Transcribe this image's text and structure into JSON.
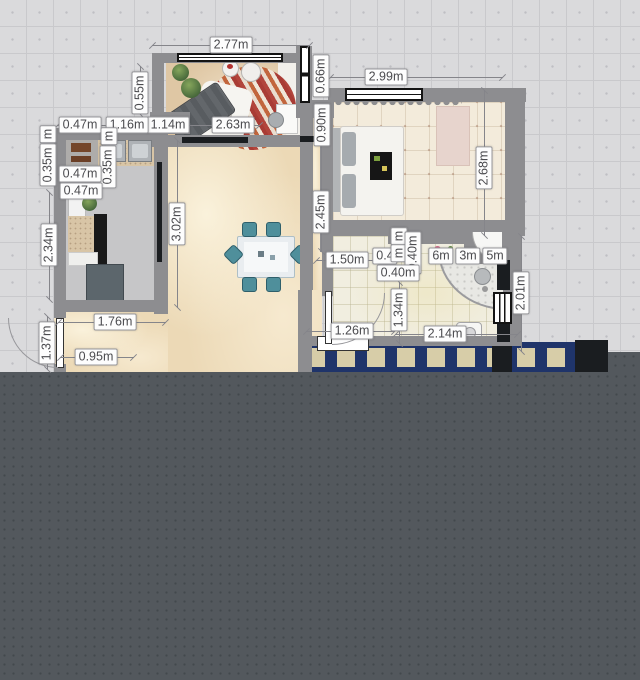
{
  "app": {
    "view": "floor-plan-2d",
    "unrendered_area": "bottom dark slate region with dot grid"
  },
  "palette": {
    "grid_bg": "#dadadc",
    "grid_line": "#c9c9cc",
    "canvas_dark": "#53585d",
    "wall_gray": "#8d8d90",
    "floor_living": "#dfc7a4",
    "floor_main": "#ecd9b6",
    "floor_bedroom": "#f3ebdb",
    "floor_bath": "#f1eee0",
    "floor_kitchen": "#c6c6c8",
    "balcony_blue": "#1f346a",
    "balcony_tile": "#d7cda8",
    "rug_red": "#b2453c",
    "chair_teal": "#4f8f9b",
    "label_bg": "#fdfdfd",
    "label_border": "#98989c",
    "label_text": "#4b4b4f"
  },
  "floorplan": {
    "dimension_labels": [
      {
        "text": "2.77m",
        "x": 231,
        "y": 45,
        "o": "h"
      },
      {
        "text": "2.99m",
        "x": 386,
        "y": 77,
        "o": "h"
      },
      {
        "text": "0.66m",
        "x": 321,
        "y": 76,
        "o": "v"
      },
      {
        "text": "0.90m",
        "x": 322,
        "y": 125,
        "o": "v"
      },
      {
        "text": "0.55m",
        "x": 140,
        "y": 93,
        "o": "v"
      },
      {
        "text": "1.14m",
        "x": 168,
        "y": 125,
        "o": "h"
      },
      {
        "text": "1.16m",
        "x": 127,
        "y": 125,
        "o": "h"
      },
      {
        "text": "0.47m",
        "x": 80,
        "y": 125,
        "o": "h"
      },
      {
        "text": "2.63m",
        "x": 233,
        "y": 125,
        "o": "h"
      },
      {
        "text": "m",
        "x": 48,
        "y": 134,
        "o": "v"
      },
      {
        "text": "m",
        "x": 109,
        "y": 136,
        "o": "v"
      },
      {
        "text": "0.35m",
        "x": 48,
        "y": 165,
        "o": "v"
      },
      {
        "text": "0.35m",
        "x": 108,
        "y": 167,
        "o": "v"
      },
      {
        "text": "0.47m",
        "x": 80,
        "y": 174,
        "o": "h"
      },
      {
        "text": "0.47m",
        "x": 81,
        "y": 191,
        "o": "h"
      },
      {
        "text": "2.34m",
        "x": 49,
        "y": 245,
        "o": "v"
      },
      {
        "text": "3.02m",
        "x": 177,
        "y": 224,
        "o": "v"
      },
      {
        "text": "2.45m",
        "x": 321,
        "y": 212,
        "o": "v"
      },
      {
        "text": "2.68m",
        "x": 484,
        "y": 168,
        "o": "v"
      },
      {
        "text": "1.50m",
        "x": 347,
        "y": 260,
        "o": "h"
      },
      {
        "text": "0.4",
        "x": 385,
        "y": 256,
        "o": "h"
      },
      {
        "text": "6m",
        "x": 441,
        "y": 256,
        "o": "h"
      },
      {
        "text": "3m",
        "x": 468,
        "y": 256,
        "o": "h"
      },
      {
        "text": "5m",
        "x": 495,
        "y": 256,
        "o": "h"
      },
      {
        "text": "m",
        "x": 399,
        "y": 236,
        "o": "v"
      },
      {
        "text": "m",
        "x": 399,
        "y": 253,
        "o": "v"
      },
      {
        "text": "0.40m",
        "x": 413,
        "y": 253,
        "o": "v"
      },
      {
        "text": "0.40m",
        "x": 398,
        "y": 273,
        "o": "h"
      },
      {
        "text": "1.34m",
        "x": 399,
        "y": 310,
        "o": "v"
      },
      {
        "text": "2.01m",
        "x": 521,
        "y": 293,
        "o": "v"
      },
      {
        "text": "1.26m",
        "x": 352,
        "y": 331,
        "o": "h"
      },
      {
        "text": "2.14m",
        "x": 445,
        "y": 334,
        "o": "h"
      },
      {
        "text": "1.76m",
        "x": 115,
        "y": 322,
        "o": "h"
      },
      {
        "text": "1.37m",
        "x": 47,
        "y": 343,
        "o": "v"
      },
      {
        "text": "0.95m",
        "x": 96,
        "y": 357,
        "o": "h"
      }
    ]
  }
}
